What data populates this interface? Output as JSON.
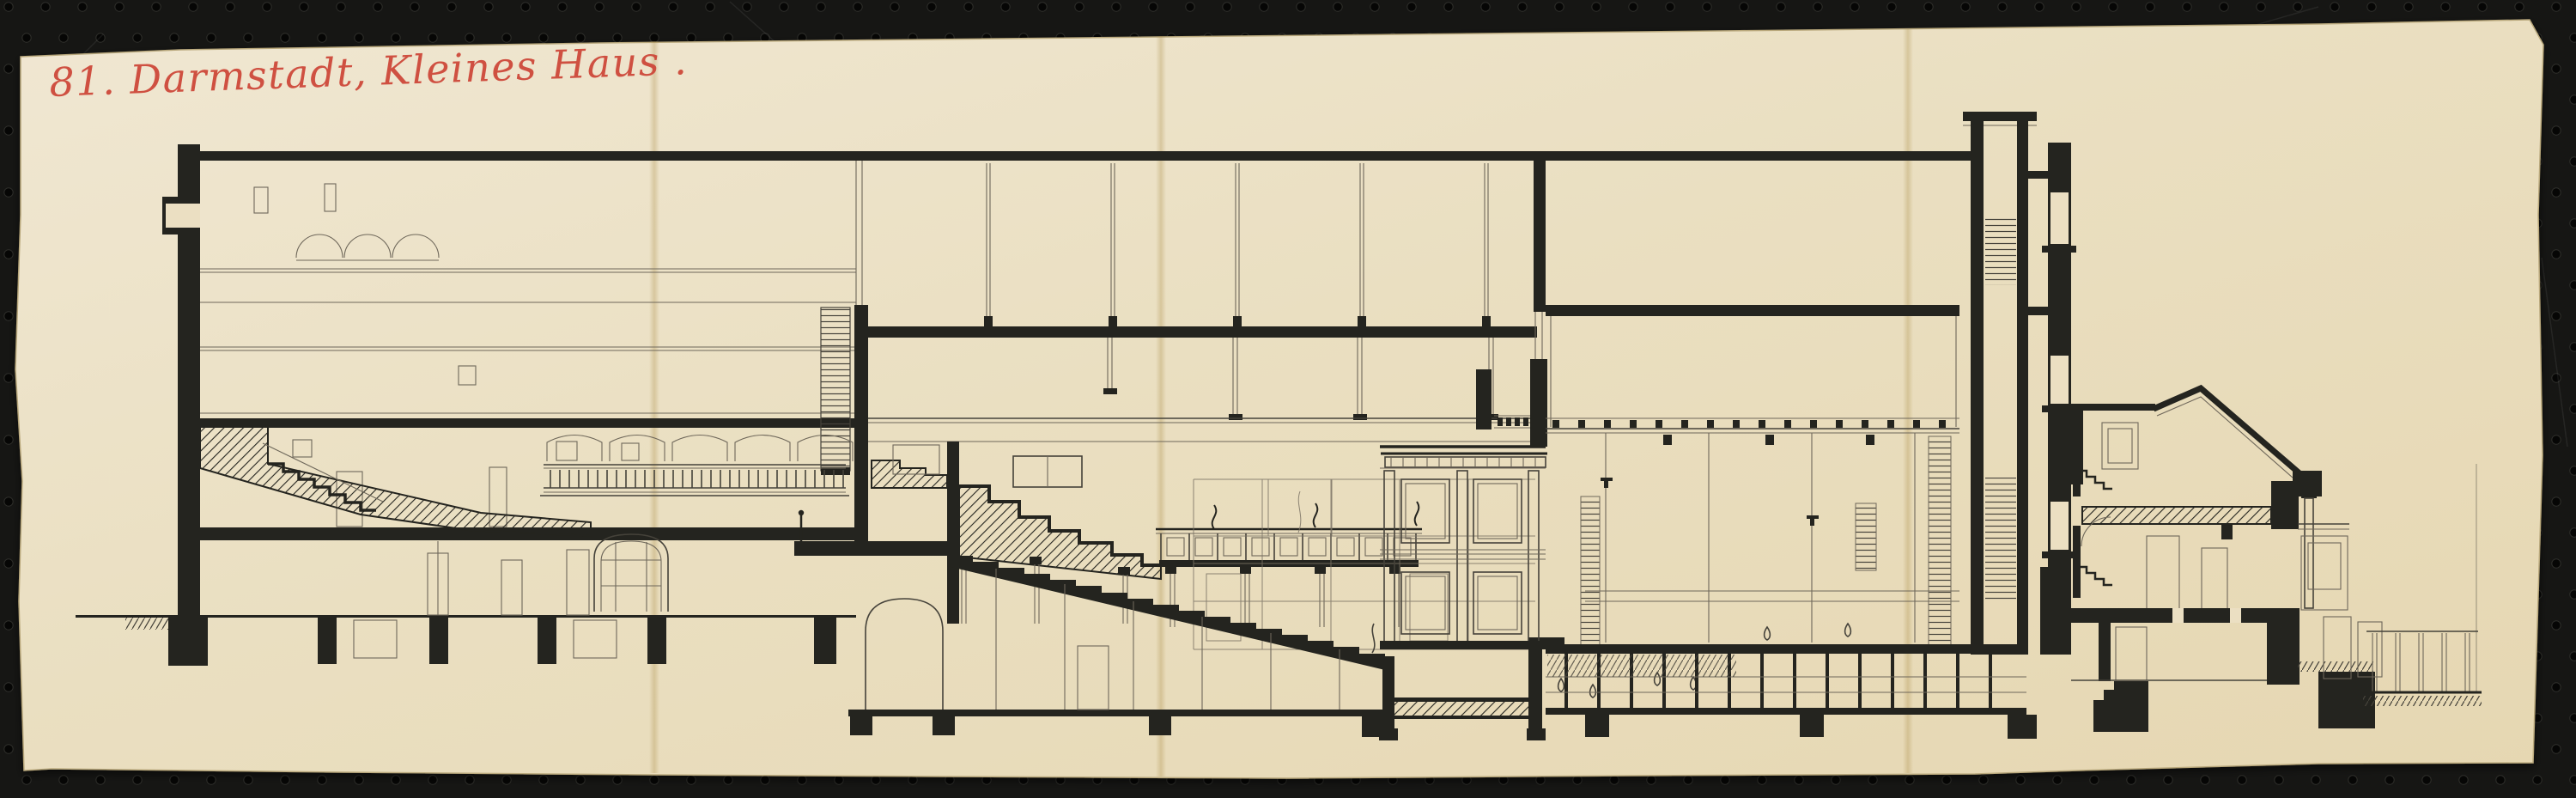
{
  "photo": {
    "annotation": {
      "text": "81. Darmstadt, Kleines Haus .",
      "color": "#cd4537",
      "medium": "red-crayon-handwriting"
    },
    "board": {
      "color": "#161614",
      "hole_color": "#060605"
    },
    "paper": {
      "color": "#ebdfc2",
      "edge_color": "#b9a87c"
    },
    "ink": {
      "heavy": "#24241f",
      "medium": "#45423a",
      "light": "#6e675a"
    },
    "drawing": {
      "subject": "longitudinal-section-theatre-building"
    }
  }
}
